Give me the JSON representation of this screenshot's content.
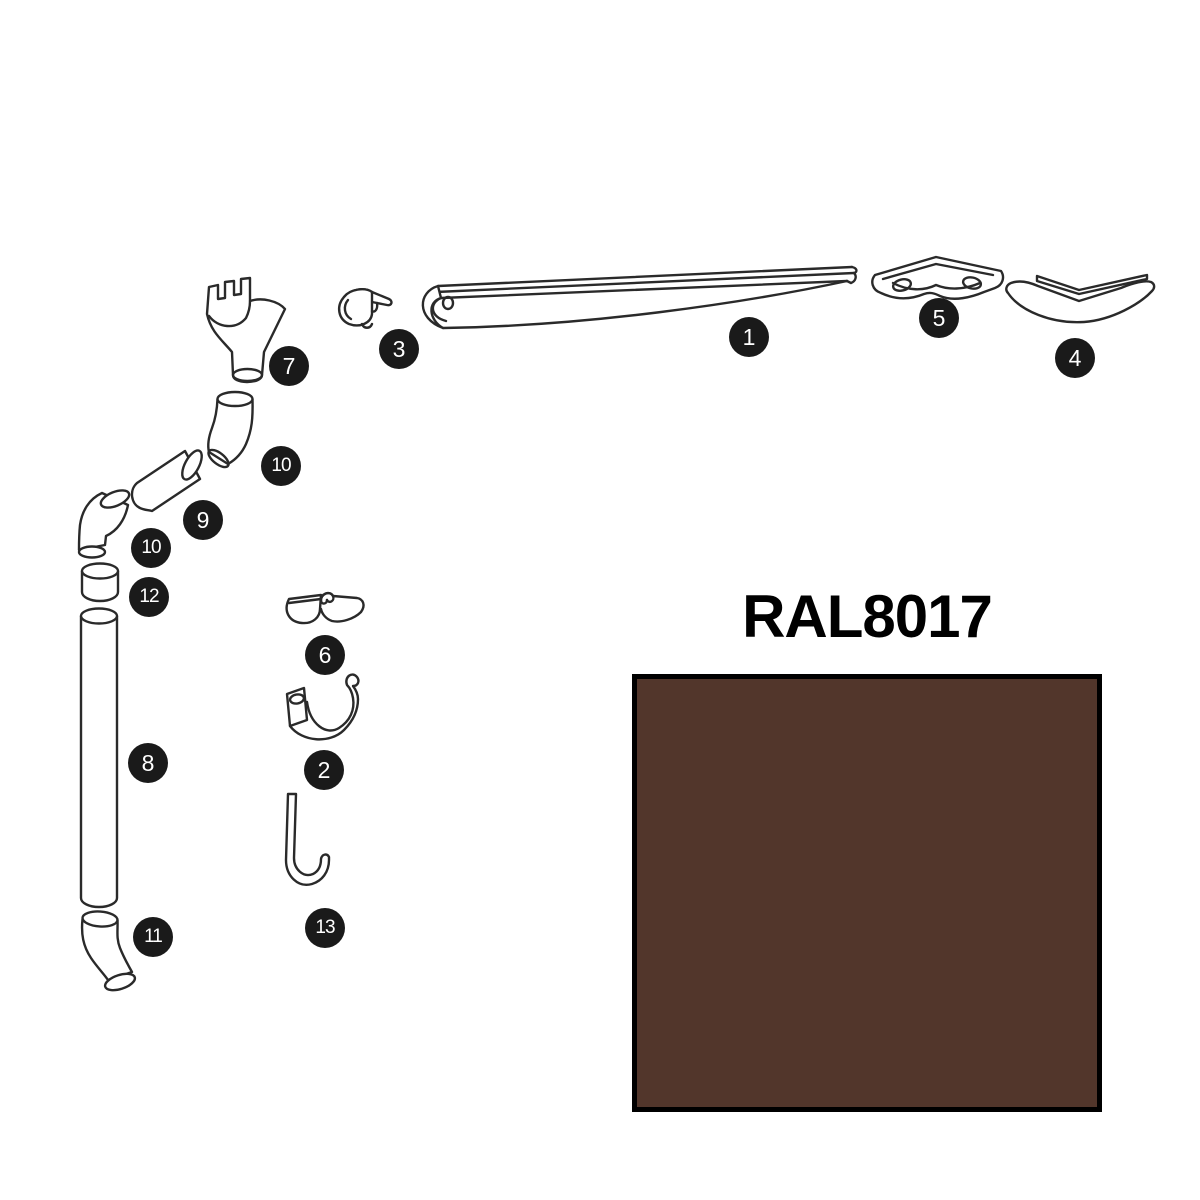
{
  "canvas": {
    "background": "#FFFFFF"
  },
  "diagram": {
    "badge_background": "#1A1A1A",
    "badge_text_color": "#FFFFFF",
    "line_color": "#2A2A2A",
    "badges": [
      {
        "id": "part-1",
        "label": "1"
      },
      {
        "id": "part-2",
        "label": "2"
      },
      {
        "id": "part-3",
        "label": "3"
      },
      {
        "id": "part-4",
        "label": "4"
      },
      {
        "id": "part-5",
        "label": "5"
      },
      {
        "id": "part-6",
        "label": "6"
      },
      {
        "id": "part-7",
        "label": "7"
      },
      {
        "id": "part-8",
        "label": "8"
      },
      {
        "id": "part-9",
        "label": "9"
      },
      {
        "id": "part-10-upper",
        "label": "10"
      },
      {
        "id": "part-10-lower",
        "label": "10"
      },
      {
        "id": "part-11",
        "label": "11"
      },
      {
        "id": "part-12",
        "label": "12"
      },
      {
        "id": "part-13",
        "label": "13"
      }
    ]
  },
  "swatch": {
    "label": "RAL8017",
    "fill": "#52362B",
    "border": "#000000"
  }
}
